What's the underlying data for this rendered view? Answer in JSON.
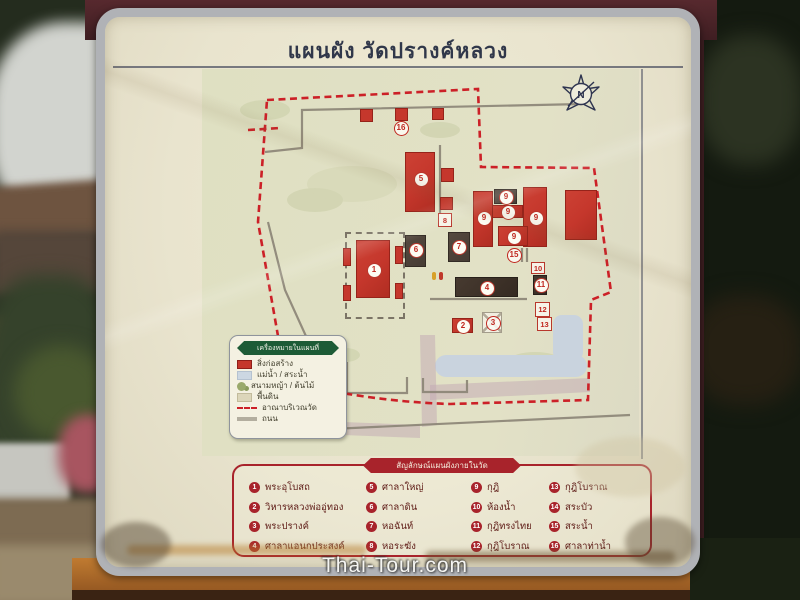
{
  "sign": {
    "title": "แผนผัง วัดปรางค์หลวง"
  },
  "compass": {
    "label": "N"
  },
  "watermark": "Thai-Tour.com",
  "legend": {
    "header": "เครื่องหมายในแผนที่",
    "items": [
      {
        "label": "สิ่งก่อสร้าง"
      },
      {
        "label": "แม่น้ำ / สระน้ำ"
      },
      {
        "label": "สนามหญ้า / ต้นไม้"
      },
      {
        "label": "พื้นดิน"
      },
      {
        "label": "อาณาบริเวณวัด"
      },
      {
        "label": "ถนน"
      }
    ]
  },
  "key": {
    "header": "สัญลักษณ์แผนผังภายในวัด",
    "items": [
      {
        "num": "1",
        "label": "พระอุโบสถ"
      },
      {
        "num": "2",
        "label": "วิหารหลวงพ่ออู่ทอง"
      },
      {
        "num": "3",
        "label": "พระปรางค์"
      },
      {
        "num": "4",
        "label": "ศาลาแอนกประสงค์"
      },
      {
        "num": "5",
        "label": "ศาลาใหญ่"
      },
      {
        "num": "6",
        "label": "ศาลาดิน"
      },
      {
        "num": "7",
        "label": "หอฉันท์"
      },
      {
        "num": "8",
        "label": "หอระฆัง"
      },
      {
        "num": "9",
        "label": "กุฎิ"
      },
      {
        "num": "10",
        "label": "ห้องน้ำ"
      },
      {
        "num": "11",
        "label": "กุฎิทรงไทย"
      },
      {
        "num": "12",
        "label": "กุฎิโบราณ"
      },
      {
        "num": "13",
        "label": "กุฎิโบราณ"
      },
      {
        "num": "14",
        "label": "สระบัว"
      },
      {
        "num": "15",
        "label": "สระน้ำ"
      },
      {
        "num": "16",
        "label": "ศาลาท่าน้ำ"
      }
    ]
  },
  "map": {
    "badges": [
      {
        "num": "1"
      },
      {
        "num": "5"
      },
      {
        "num": "6"
      },
      {
        "num": "7"
      },
      {
        "num": "8"
      },
      {
        "num": "9"
      },
      {
        "num": "9"
      },
      {
        "num": "9"
      },
      {
        "num": "9"
      },
      {
        "num": "9"
      },
      {
        "num": "4"
      },
      {
        "num": "10"
      },
      {
        "num": "11"
      },
      {
        "num": "2"
      },
      {
        "num": "3"
      },
      {
        "num": "12"
      },
      {
        "num": "13"
      },
      {
        "num": "15"
      },
      {
        "num": "16"
      }
    ]
  },
  "colors": {
    "key_red": "#a8232b",
    "building_red": "#c5372c",
    "boundary_red": "#cc2027",
    "legend_green": "#1d5b36",
    "panel_cream": "#e9e4ce",
    "water_blue": "#c9d3de",
    "dark_building": "#4a423b",
    "frame_silver": "#b0b2b6",
    "wood_orange": "#b06a2a",
    "post_maroon": "#3c1e21"
  }
}
